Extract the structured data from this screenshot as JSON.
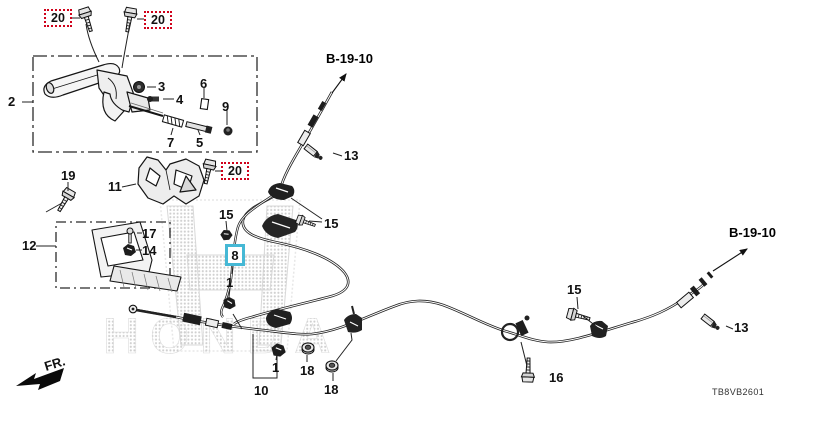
{
  "watermark": "HONDA",
  "front_marker": "FR.",
  "diagram_code": "TB8VB2601",
  "refs": {
    "top": "B-19-10",
    "right": "B-19-10"
  },
  "highlight": {
    "selected_part": "8",
    "selected_box_color": "#45b8d5",
    "callout_box_color": "#d0021b"
  },
  "part_numbers": {
    "1": "1",
    "2": "2",
    "3": "3",
    "4": "4",
    "5": "5",
    "6": "6",
    "7": "7",
    "8": "8",
    "9": "9",
    "10": "10",
    "11": "11",
    "12": "12",
    "13": "13",
    "14": "14",
    "15": "15",
    "16": "16",
    "17": "17",
    "18": "18",
    "19": "19",
    "20": "20"
  }
}
